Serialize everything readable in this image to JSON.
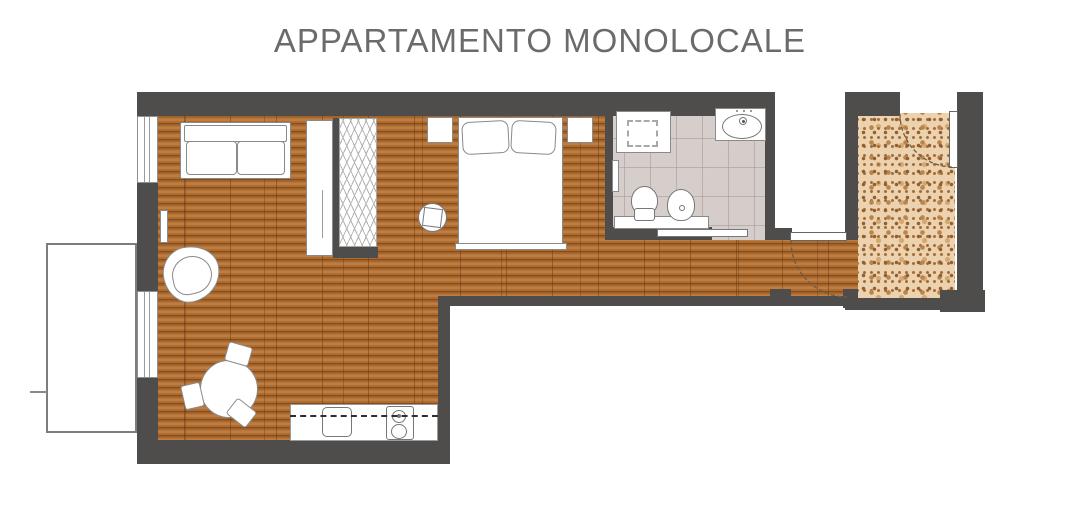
{
  "title": "APPARTAMENTO MONOLOCALE",
  "palette": {
    "wall": "#4e4d4b",
    "wood_floor": "#b06c2e",
    "wood_joint": "#57320a",
    "bathroom_tile": "#dad3d0",
    "entry_terrazzo": "#ecd2ae",
    "terrazzo_speckle": "#8f5e31",
    "furniture_fill": "#ffffff",
    "furniture_outline": "#8a8a8a",
    "door_swing_arc": "#6d5b46",
    "title_text": "#6b6b6b",
    "background": "#ffffff"
  },
  "plan": {
    "zones": [
      {
        "name": "living-dining-area",
        "floor": "wood"
      },
      {
        "name": "sleeping-area",
        "floor": "wood"
      },
      {
        "name": "corridor",
        "floor": "wood"
      },
      {
        "name": "bathroom",
        "floor": "tile"
      },
      {
        "name": "entry-hall",
        "floor": "terrazzo"
      },
      {
        "name": "balcony",
        "floor": "white"
      }
    ],
    "symbols": [
      "sofa",
      "armchair",
      "wardrobe-cabinet",
      "open-closet",
      "radiator",
      "double-bed",
      "pillows",
      "nightstand-left",
      "nightstand-right",
      "side-table",
      "dining-table",
      "dining-chairs",
      "kitchen-counter",
      "kitchen-sink",
      "cooktop",
      "upper-cabinets-dashed",
      "shower-tray",
      "washbasin",
      "toilet",
      "bidet",
      "bathroom-vanity",
      "bathroom-radiator",
      "sliding-door",
      "corridor-door",
      "entry-door",
      "door-swing-arcs",
      "windows",
      "balcony"
    ]
  }
}
